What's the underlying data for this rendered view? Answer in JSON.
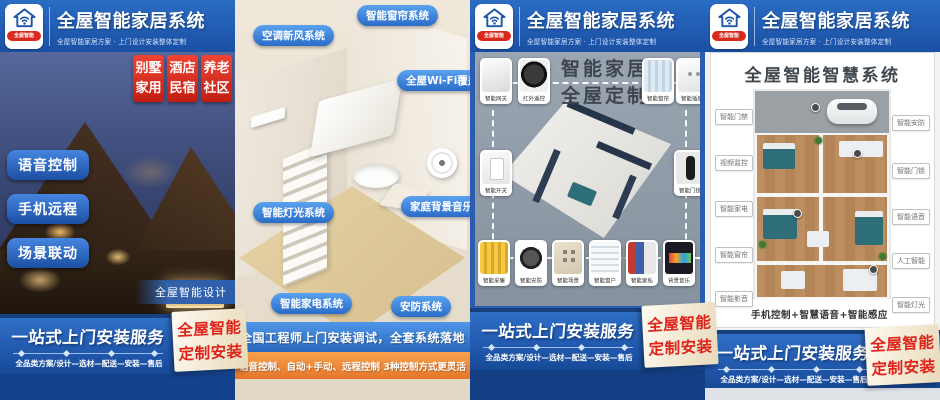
{
  "colors": {
    "header_blue": "#1e55a9",
    "accent_red": "#df231b",
    "pill_blue": "#2f6fd0",
    "bar_orange": "#e5762a",
    "panel3_gray": "#8f9aa7",
    "ribbon_cream": "#f4ebd5",
    "panel2_beige": "#e8dfd0"
  },
  "brand": {
    "logo_icon": "house-wifi-icon",
    "badge": "全屋智能",
    "title": "全屋智能家居系统",
    "subtitle": "全屋智能家居方案 · 上门设计安装整体定制"
  },
  "footer": {
    "headline": "一站式上门安装服务",
    "steps": "全品类方案/设计—选材—配送—安装—售后",
    "ribbon_line1": "全屋智能",
    "ribbon_line2": "定制安装"
  },
  "poster1": {
    "tags": [
      {
        "l1": "别墅",
        "l2": "家用"
      },
      {
        "l1": "酒店",
        "l2": "民宿"
      },
      {
        "l1": "养老",
        "l2": "社区"
      }
    ],
    "pills": [
      "语音控制",
      "手机远程",
      "场景联动"
    ],
    "caption": "全屋智能设计"
  },
  "poster2": {
    "labels": [
      "空调新风系统",
      "智能窗帘系统",
      "全屋Wi-Fi覆盖",
      "智能灯光系统",
      "家庭背景音乐",
      "智能家电系统",
      "安防系统"
    ],
    "bar_blue": "全国工程师上门安装调试，全套系统落地",
    "bar_orange": "语音控制、自动+手动、远程控制  3种控制方式更灵活"
  },
  "poster3": {
    "title_line1": "智能家居",
    "title_line2": "全屋定制",
    "devices": {
      "top": [
        "智能网关",
        "红外遥控",
        "智能窗帘",
        "智能插座"
      ],
      "left": "智能开关",
      "right": "智能门锁",
      "bottom": [
        "智能采暖",
        "智能安防",
        "智能场景",
        "智能窗户",
        "智能家私",
        "背景音乐"
      ]
    }
  },
  "poster4": {
    "title": "全屋智能智慧系统",
    "labels_left": [
      "智能门禁",
      "视频监控",
      "智能家电",
      "智能窗帘",
      "智能影音"
    ],
    "labels_right": [
      "智能安防",
      "智能门锁",
      "智能语音",
      "人工智能",
      "智能灯光"
    ],
    "caption": "手机控制+智慧语音+智能感应"
  }
}
